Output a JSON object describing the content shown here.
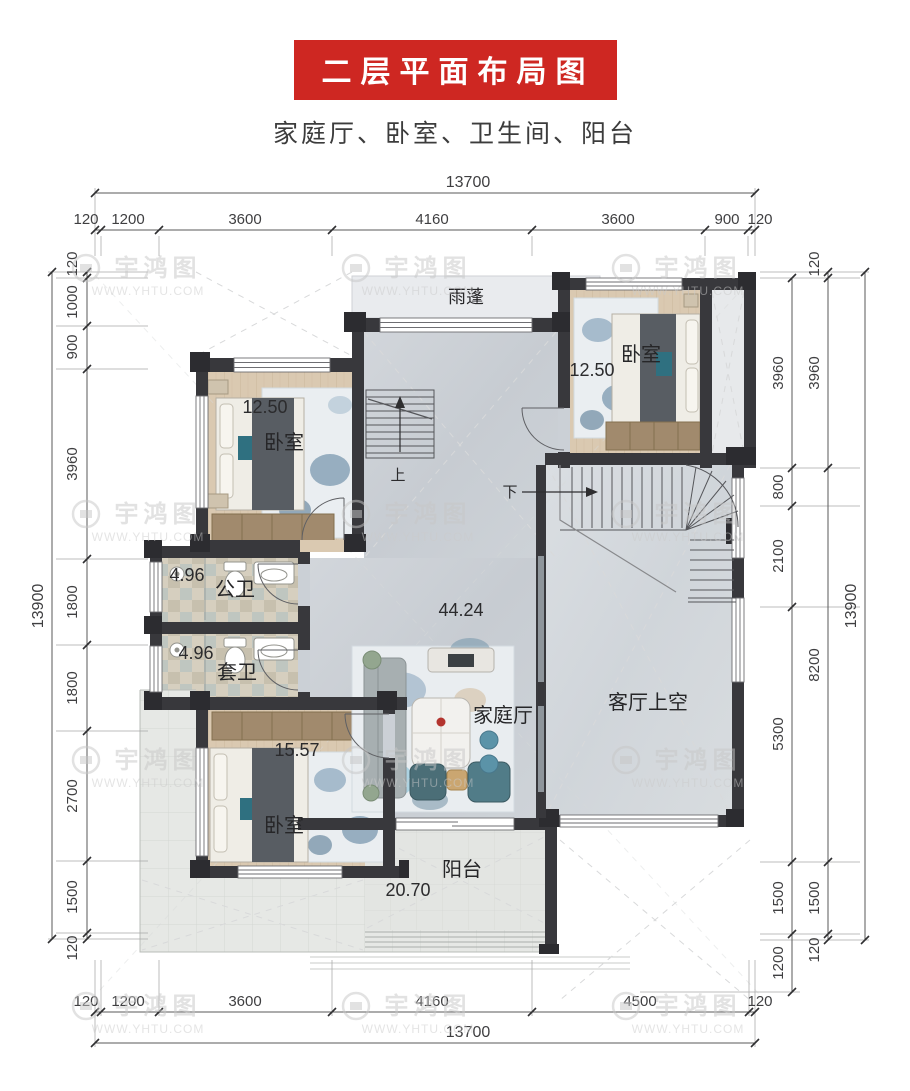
{
  "header": {
    "title": "二层平面布局图",
    "subtitle": "家庭厅、卧室、卫生间、阳台",
    "banner_color": "#ce2722"
  },
  "watermark": {
    "brand": "宇鸿图",
    "url": "WWW.YHTU.COM"
  },
  "rooms": {
    "canopy": {
      "label": "雨蓬"
    },
    "bedroom_top_left": {
      "label": "卧室",
      "area": "12.50"
    },
    "bedroom_top_right": {
      "label": "卧室",
      "area": "12.50"
    },
    "bath_public": {
      "label": "公卫",
      "area": "4.96"
    },
    "bath_ensuite": {
      "label": "套卫",
      "area": "4.96"
    },
    "family_hall": {
      "label": "家庭厅",
      "area": "44.24"
    },
    "living_void": {
      "label": "客厅上空"
    },
    "bedroom_bottom": {
      "label": "卧室",
      "area": "15.57"
    },
    "balcony": {
      "label": "阳台",
      "area": "20.70"
    }
  },
  "stairs": {
    "up": "上",
    "down": "下"
  },
  "dimensions": {
    "top": {
      "total": "13700",
      "segments": [
        "120",
        "1200",
        "3600",
        "4160",
        "3600",
        "900",
        "120"
      ]
    },
    "bottom": {
      "total": "13700",
      "segments": [
        "120",
        "1200",
        "3600",
        "4160",
        "4500",
        "120"
      ]
    },
    "left": {
      "total": "13900",
      "segments": [
        "120",
        "1000",
        "900",
        "3960",
        "1800",
        "1800",
        "2700",
        "1500",
        "120"
      ]
    },
    "right": {
      "total": "13900",
      "inner": [
        "3960",
        "800",
        "2100",
        "5300",
        "1500",
        "1200"
      ],
      "outer": [
        "120",
        "3960",
        "8200",
        "1500",
        "120"
      ]
    }
  }
}
